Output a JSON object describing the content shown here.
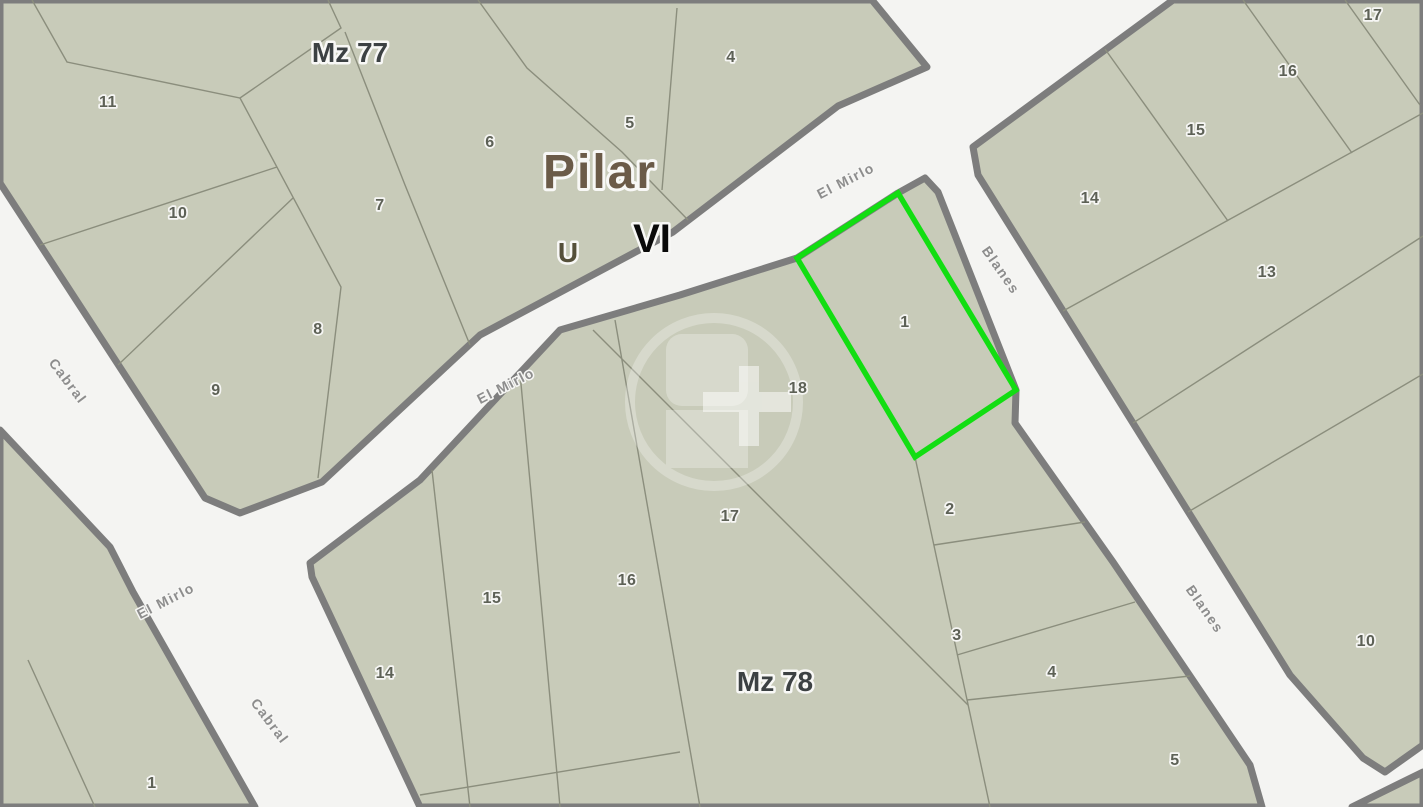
{
  "map": {
    "city": "Pilar",
    "zone": "VI",
    "subzone": "U",
    "block_labels": {
      "mz77": "Mz 77",
      "mz78": "Mz 78"
    },
    "streets": {
      "el_mirlo": "El Mirlo",
      "cabral": "Cabral",
      "blanes": "Blanes"
    },
    "highlighted_lot": {
      "number": "1",
      "block": "Mz 78",
      "outline_color": "#12de12"
    },
    "lots": {
      "mz77": [
        "11",
        "10",
        "9",
        "8",
        "7",
        "6",
        "5",
        "4"
      ],
      "block_ne": [
        "17",
        "16",
        "15",
        "14",
        "13",
        "10"
      ],
      "mz78": [
        "18",
        "17",
        "16",
        "15",
        "14",
        "2",
        "3",
        "4",
        "5"
      ],
      "block_sw": [
        "1"
      ]
    },
    "colors": {
      "parcel_fill": "#c8cbb9",
      "street_fill": "#f4f4f2",
      "block_border": "#7d7d7d",
      "lot_line": "#8b8e7d",
      "highlight_green": "#12de12"
    }
  }
}
